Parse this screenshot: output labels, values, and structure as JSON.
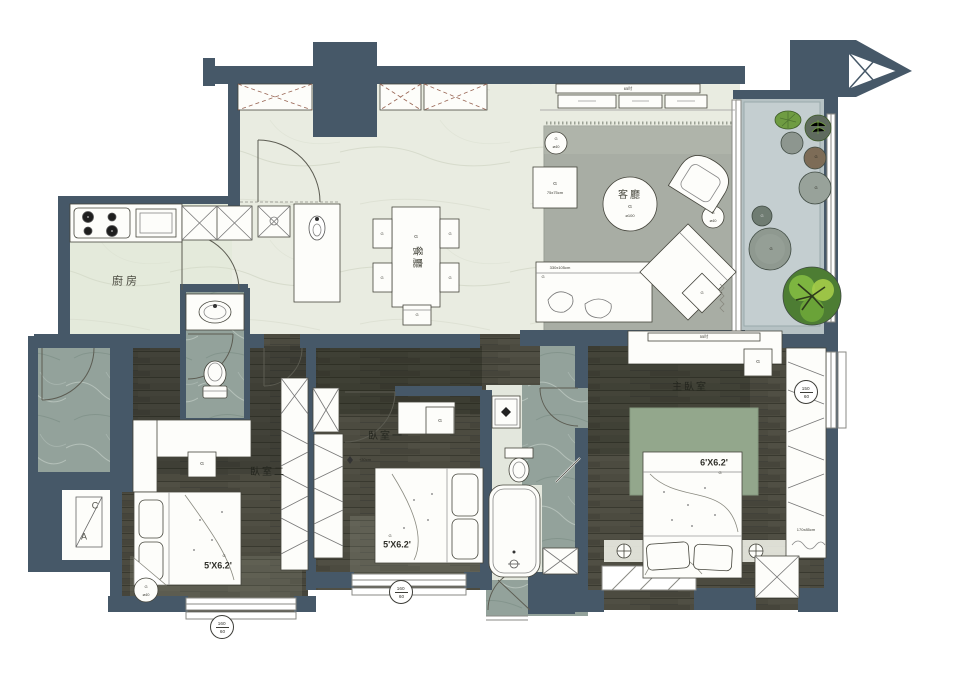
{
  "plan": {
    "rooms": {
      "kitchen": "廚房",
      "dining": "餐廳",
      "living": "客廳",
      "bedroom_left": "臥室二",
      "bedroom_mid": "臥室一",
      "master": "主臥室"
    },
    "dims": {
      "tv_living": "65吋",
      "tv_master": "55吋",
      "coffee_table": "⌀100",
      "side_table": "75x75cm",
      "sofa": "330x105cm",
      "stool": "⌀40",
      "bed_small": "5'X6.2'",
      "bed_master": "6'X6.2'",
      "wardrobe": "170x85cm",
      "closet_note": "+30cm"
    },
    "windows": {
      "w1": {
        "top": "160",
        "bottom": "60"
      },
      "w2": {
        "top": "150",
        "bottom": "60"
      }
    },
    "ac": {
      "c": "C",
      "a": "A"
    },
    "tag": "G"
  },
  "colors": {
    "wall": "#465868",
    "wood": "#4c4b40",
    "marble": "#93a29b",
    "light_floor": "#e9ece1",
    "balcony": "#b6c2c4",
    "rug_living": "#a8ada4",
    "rug_master": "#93a78c",
    "tree": "#7db540"
  }
}
